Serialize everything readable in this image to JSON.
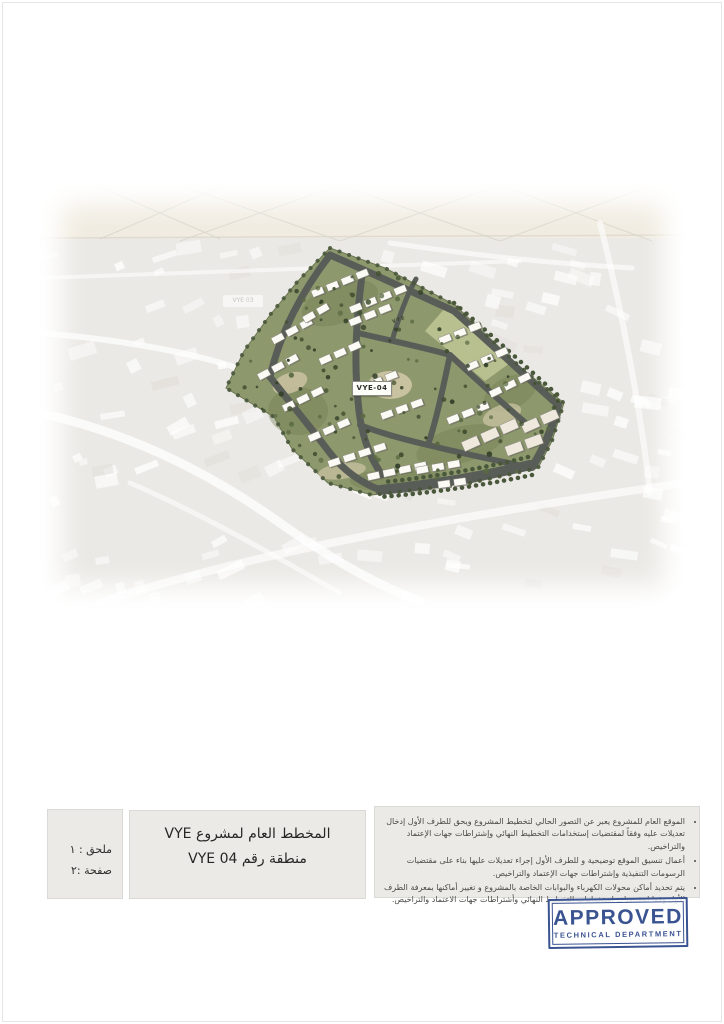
{
  "map": {
    "site_label": "VYE-04",
    "lawn_label": "VYE",
    "faded_area_label": "VYE 03"
  },
  "info_bar": {
    "annex_box": {
      "line1": "ملحق : ١",
      "line2": "صفحة :٢"
    },
    "title_box": {
      "line1": "المخطط العام  لمشروع VYE",
      "line2": "منطقة رقم  VYE 04"
    },
    "notes_box": {
      "bullets": [
        "الموقع العام للمشروع يعبر عن التصور الحالي لتخطيط المشروع ويحق للطرف الأول إدخال تعديلات عليه وفقاً لمقتضيات إستخدامات التخطيط النهائي وإشتراطات جهات الإعتماد والتراخيص.",
        "أعمال تنسيق الموقع توضيحية و للطرف الأول إجراء تعديلات عليها بناء على مقتضيات الرسومات التنفيذية وإشتراطات جهات الإعتماد والتراخيص.",
        "يتم تحديد أماكن محولات الكهرباء والبوابات الخاصة بالمشروع و تغيير أماكنها بمعرفة الطرف الأول وفقا لمقتضيات استخدامات التخطيط النهائي وأشتراطات جهات الاعتماد والتراخيص."
      ]
    }
  },
  "stamp": {
    "line1": "APPROVED",
    "line2": "TECHNICAL DEPARTMENT",
    "color": "#3a5391"
  }
}
